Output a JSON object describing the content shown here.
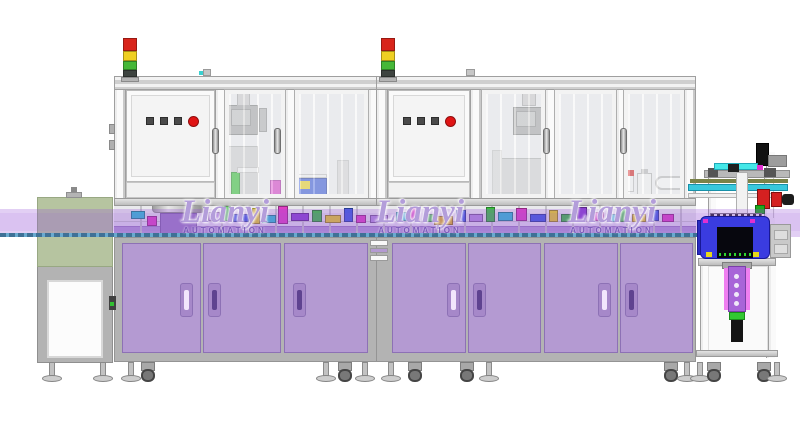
{
  "brand": {
    "name": "Lianyi",
    "subtitle": "AUTOMATION"
  },
  "watermarks": [
    {
      "cx": 225
    },
    {
      "cx": 420
    },
    {
      "cx": 612
    }
  ],
  "colors": {
    "cabinet_door": "#b49ad2",
    "cabinet_door_border": "#8d71b5",
    "handle_recess": "#a688c9",
    "handle_slot_light": "#f2e6fc",
    "handle_slot_dark": "#5f4390",
    "frame_gray": "#b3b3b3",
    "signal_red": "#d8251b",
    "signal_yellow": "#efcf22",
    "signal_green": "#46b838",
    "estop_red": "#e01414",
    "blue_housing": "#3a3ce0",
    "green_cover": "#b6c4a0",
    "overlay_band": "rgba(152,84,214,0.28)",
    "conveyor_teal": "#1e7d7d",
    "actuator_purple": "#a864d8",
    "actuator_pink": "#ef7ef0"
  },
  "signal_towers": {
    "xs": [
      123,
      381
    ],
    "segments": [
      {
        "name": "red",
        "color": "#d8251b",
        "h": 13
      },
      {
        "name": "yellow",
        "color": "#efcf22",
        "h": 10
      },
      {
        "name": "green",
        "color": "#46b838",
        "h": 9
      },
      {
        "name": "pole",
        "color": "#3e4440",
        "h": 7
      }
    ]
  },
  "control_panels": [
    {
      "squares": [
        146,
        160,
        174
      ],
      "red": 188,
      "y": 117
    },
    {
      "squares": [
        403,
        417,
        431
      ],
      "red": 445,
      "y": 117
    }
  ],
  "enclosure": {
    "posts": [
      {
        "x": 114,
        "w": 12
      },
      {
        "x": 215,
        "w": 12
      },
      {
        "x": 285,
        "w": 12
      },
      {
        "x": 368,
        "w": 12
      },
      {
        "x": 376,
        "w": 12
      },
      {
        "x": 470,
        "w": 12
      },
      {
        "x": 545,
        "w": 10
      },
      {
        "x": 616,
        "w": 8
      },
      {
        "x": 684,
        "w": 12
      }
    ],
    "glass_doors": [
      {
        "x": 225,
        "w": 60
      },
      {
        "x": 295,
        "w": 73
      },
      {
        "x": 482,
        "w": 63
      },
      {
        "x": 555,
        "w": 61
      },
      {
        "x": 624,
        "w": 60
      }
    ],
    "door_handles": [
      212,
      274,
      543,
      620
    ]
  },
  "cabinets": {
    "doors": [
      {
        "x": 122,
        "w": 79,
        "handle_x": 180,
        "slot": "light"
      },
      {
        "x": 203,
        "w": 78,
        "handle_x": 208,
        "slot": "dark"
      },
      {
        "x": 284,
        "w": 84,
        "handle_x": 293,
        "slot": "dark"
      },
      {
        "x": 392,
        "w": 74,
        "handle_x": 447,
        "slot": "light"
      },
      {
        "x": 468,
        "w": 73,
        "handle_x": 473,
        "slot": "dark"
      },
      {
        "x": 544,
        "w": 74,
        "handle_x": 598,
        "slot": "light"
      },
      {
        "x": 620,
        "w": 73,
        "handle_x": 625,
        "slot": "dark"
      }
    ]
  },
  "junction_vents": [
    {
      "y": 240,
      "h": 6,
      "type": "white"
    },
    {
      "y": 248,
      "h": 5,
      "type": "purple"
    },
    {
      "y": 255,
      "h": 6,
      "type": "white"
    }
  ],
  "block_palette": {
    "cyan": "#2cc4d4",
    "magenta": "#df3fc3",
    "green": "#38c23c",
    "blue": "#3a5ce0",
    "yellow": "#e8d222",
    "gold": "#e0b81e",
    "purple": "#8a3fd0",
    "violet": "#b590dd"
  },
  "equipment_blocks": [
    [
      131,
      211,
      14,
      8,
      "cyan"
    ],
    [
      147,
      216,
      10,
      10,
      "magenta"
    ],
    [
      208,
      212,
      12,
      9,
      "violet"
    ],
    [
      222,
      206,
      9,
      15,
      "green"
    ],
    [
      233,
      214,
      16,
      8,
      "blue"
    ],
    [
      252,
      208,
      8,
      16,
      "yellow"
    ],
    [
      262,
      215,
      14,
      8,
      "cyan"
    ],
    [
      278,
      206,
      10,
      18,
      "magenta"
    ],
    [
      291,
      213,
      18,
      8,
      "purple"
    ],
    [
      312,
      210,
      10,
      12,
      "green"
    ],
    [
      325,
      215,
      16,
      8,
      "yellow"
    ],
    [
      344,
      208,
      9,
      14,
      "blue"
    ],
    [
      356,
      215,
      10,
      8,
      "magenta"
    ],
    [
      370,
      215,
      18,
      8,
      "violet"
    ],
    [
      396,
      212,
      12,
      9,
      "cyan"
    ],
    [
      410,
      207,
      10,
      14,
      "magenta"
    ],
    [
      424,
      214,
      12,
      8,
      "green"
    ],
    [
      434,
      216,
      19,
      9,
      "gold"
    ],
    [
      456,
      210,
      10,
      12,
      "blue"
    ],
    [
      469,
      214,
      14,
      8,
      "violet"
    ],
    [
      486,
      207,
      9,
      15,
      "green"
    ],
    [
      498,
      212,
      15,
      9,
      "cyan"
    ],
    [
      516,
      208,
      11,
      13,
      "magenta"
    ],
    [
      530,
      214,
      16,
      8,
      "blue"
    ],
    [
      549,
      210,
      9,
      12,
      "yellow"
    ],
    [
      561,
      214,
      13,
      8,
      "green"
    ],
    [
      577,
      207,
      10,
      15,
      "purple"
    ],
    [
      590,
      212,
      14,
      9,
      "magenta"
    ],
    [
      607,
      214,
      10,
      8,
      "cyan"
    ],
    [
      620,
      209,
      9,
      13,
      "green"
    ],
    [
      632,
      214,
      14,
      8,
      "yellow"
    ],
    [
      649,
      210,
      10,
      11,
      "blue"
    ],
    [
      662,
      214,
      12,
      8,
      "magenta"
    ]
  ],
  "feet": [
    {
      "type": "foot",
      "x": 52
    },
    {
      "type": "foot",
      "x": 103
    },
    {
      "type": "foot",
      "x": 131
    },
    {
      "type": "caster",
      "x": 148
    },
    {
      "type": "foot",
      "x": 326
    },
    {
      "type": "caster",
      "x": 345
    },
    {
      "type": "foot",
      "x": 365
    },
    {
      "type": "foot",
      "x": 391
    },
    {
      "type": "caster",
      "x": 415
    },
    {
      "type": "caster",
      "x": 467
    },
    {
      "type": "foot",
      "x": 489
    },
    {
      "type": "caster",
      "x": 671
    },
    {
      "type": "foot",
      "x": 687
    },
    {
      "type": "foot",
      "x": 700
    },
    {
      "type": "caster",
      "x": 714
    },
    {
      "type": "caster",
      "x": 764
    },
    {
      "type": "foot",
      "x": 777
    }
  ],
  "actuator_holes": [
    274,
    283,
    292,
    301
  ]
}
